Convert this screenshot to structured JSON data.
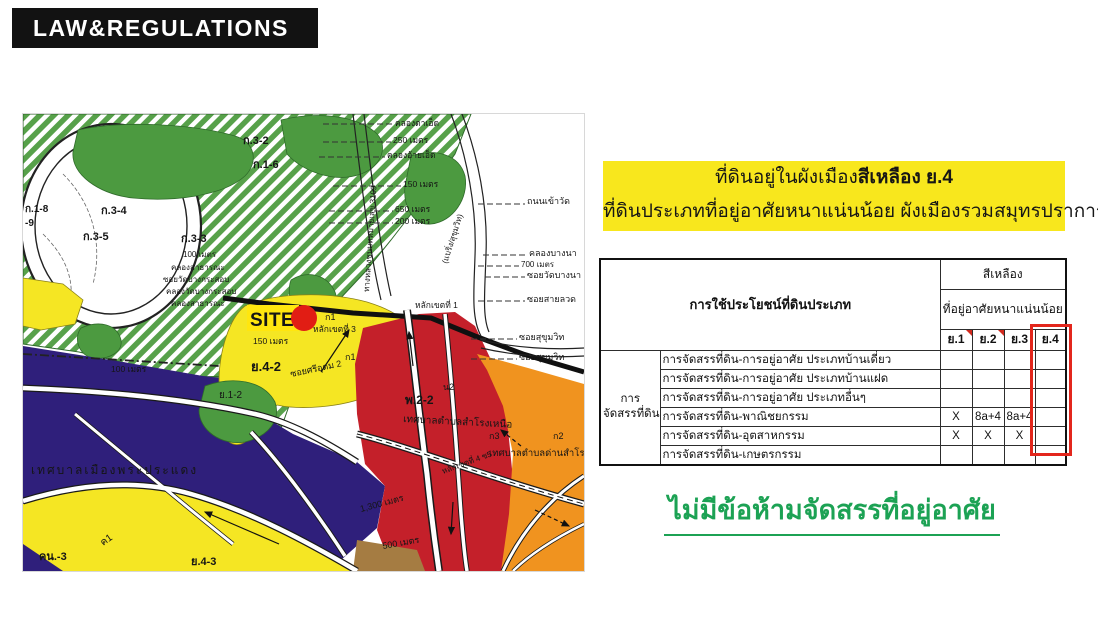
{
  "header": {
    "title": "LAW&REGULATIONS"
  },
  "highlight_box": {
    "bg_color": "#F8E71D",
    "line1_prefix": "ที่ดินอยู่ในผังเมือง",
    "line1_bold": "สีเหลือง ย.4",
    "line2": "ที่ดินประเภทที่อยู่อาศัยหนาแน่นน้อย ผังเมืองรวมสมุทรปราการ"
  },
  "table": {
    "corner_header": "การใช้ประโยชน์ที่ดินประเภท",
    "group_header": "สีเหลือง",
    "sub_header": "ที่อยู่อาศัยหนาแน่นน้อย",
    "columns": [
      "ย.1",
      "ย.2",
      "ย.3",
      "ย.4"
    ],
    "highlight_column": "ย.4",
    "highlight_color": "#E3261C",
    "row_group_label_lines": [
      "การ",
      "จัดสรรที่ดิน"
    ],
    "rows": [
      {
        "label": "การจัดสรรที่ดิน-การอยู่อาศัย ประเภทบ้านเดี่ยว",
        "values": [
          "",
          "",
          "",
          ""
        ]
      },
      {
        "label": "การจัดสรรที่ดิน-การอยู่อาศัย ประเภทบ้านแฝด",
        "values": [
          "",
          "",
          "",
          ""
        ]
      },
      {
        "label": "การจัดสรรที่ดิน-การอยู่อาศัย ประเภทอื่นๆ",
        "values": [
          "",
          "",
          "",
          ""
        ]
      },
      {
        "label": "การจัดสรรที่ดิน-พาณิชยกรรม",
        "values": [
          "X",
          "8a+4",
          "8a+4",
          ""
        ]
      },
      {
        "label": "การจัดสรรที่ดิน-อุตสาหกรรม",
        "values": [
          "X",
          "X",
          "X",
          ""
        ]
      },
      {
        "label": "การจัดสรรที่ดิน-เกษตรกรรม",
        "values": [
          "",
          "",
          "",
          ""
        ]
      }
    ]
  },
  "conclusion": {
    "text": "ไม่มีข้อห้ามจัดสรรที่อยู่อาศัย",
    "color": "#1CA254"
  },
  "map": {
    "site_label": "SITE",
    "colors": {
      "yellow_zone": "#F5E623",
      "purple_zone": "#2F1F7B",
      "red_zone": "#C4202A",
      "orange_zone": "#F0931F",
      "green_zone": "#4C9A40",
      "green_hatch": "#57A14A",
      "brown_zone": "#A57C42",
      "site_marker": "#E11D14"
    },
    "labels": [
      {
        "t": "ก.1-8",
        "x": 2,
        "y": 98,
        "s": 10,
        "b": 1
      },
      {
        "t": "-9",
        "x": 2,
        "y": 112,
        "s": 10,
        "b": 1
      },
      {
        "t": "ก.3-4",
        "x": 78,
        "y": 100,
        "s": 11,
        "b": 1
      },
      {
        "t": "ก.3-5",
        "x": 60,
        "y": 126,
        "s": 11,
        "b": 1
      },
      {
        "t": "ก.3-3",
        "x": 158,
        "y": 128,
        "s": 11,
        "b": 1
      },
      {
        "t": "ก.3-2",
        "x": 220,
        "y": 30,
        "s": 11,
        "b": 1
      },
      {
        "t": "ก.1-6",
        "x": 230,
        "y": 54,
        "s": 11,
        "b": 1
      },
      {
        "t": "100 เมตร",
        "x": 160,
        "y": 143,
        "s": 8
      },
      {
        "t": "คลองสาธารณะ",
        "x": 148,
        "y": 156,
        "s": 8
      },
      {
        "t": "ซอยวัดบางกระสอบ",
        "x": 140,
        "y": 168,
        "s": 8
      },
      {
        "t": "คลองวัดบางกระสอบ",
        "x": 143,
        "y": 180,
        "s": 8
      },
      {
        "t": "คลองสาธารณะ",
        "x": 148,
        "y": 192,
        "s": 8
      },
      {
        "t": "คลองตาเอ็ด",
        "x": 372,
        "y": 12,
        "s": 8.5
      },
      {
        "t": "250 เมตร",
        "x": 370,
        "y": 29,
        "s": 8.5
      },
      {
        "t": "คลองอ้ายเอ็ด",
        "x": 364,
        "y": 44,
        "s": 8.5
      },
      {
        "t": "150 เมตร",
        "x": 380,
        "y": 73,
        "s": 8.5
      },
      {
        "t": "650 เมตร",
        "x": 372,
        "y": 98,
        "s": 8.5
      },
      {
        "t": "200 เมตร",
        "x": 372,
        "y": 110,
        "s": 8.5
      },
      {
        "t": "ทางหลวงชนบทหมายเลข 3109",
        "x": 346,
        "y": 178,
        "s": 8,
        "r": -86
      },
      {
        "t": "(แบริ่ง/สุขุมวิท)",
        "x": 424,
        "y": 150,
        "s": 8,
        "r": -72
      },
      {
        "t": "ถนนเข้าวัด",
        "x": 504,
        "y": 90,
        "s": 9
      },
      {
        "t": "คลองบางนา",
        "x": 506,
        "y": 142,
        "s": 9
      },
      {
        "t": "700 เมตร",
        "x": 498,
        "y": 153,
        "s": 8
      },
      {
        "t": "ซอยวัดบางนา",
        "x": 504,
        "y": 164,
        "s": 9
      },
      {
        "t": "ซอยสายลวด",
        "x": 504,
        "y": 188,
        "s": 9
      },
      {
        "t": "ซอยสุขุมวิท",
        "x": 496,
        "y": 226,
        "s": 9
      },
      {
        "t": "ซอยสุขุมวิท",
        "x": 496,
        "y": 246,
        "s": 9
      },
      {
        "t": "หลักเขตที่ 1",
        "x": 392,
        "y": 194,
        "s": 8.5
      },
      {
        "t": "หลักเขตที่ 3",
        "x": 290,
        "y": 218,
        "s": 8.5
      },
      {
        "t": "ก1",
        "x": 302,
        "y": 206,
        "s": 9
      },
      {
        "t": "ก1",
        "x": 322,
        "y": 246,
        "s": 9
      },
      {
        "t": "ซอยศรีอุดม 2",
        "x": 268,
        "y": 263,
        "s": 9,
        "r": -12
      },
      {
        "t": "ย.4-2",
        "x": 228,
        "y": 257,
        "s": 13,
        "b": 1
      },
      {
        "t": "150 เมตร",
        "x": 230,
        "y": 230,
        "s": 8.5
      },
      {
        "t": "100 เมตร",
        "x": 88,
        "y": 258,
        "s": 8.5
      },
      {
        "t": "ย.1-2",
        "x": 196,
        "y": 284,
        "s": 10,
        "c": "rgba(255,255,255,0.4)"
      },
      {
        "t": "เทศบาลเมืองพระประแดง",
        "x": 8,
        "y": 360,
        "s": 12,
        "c": "rgba(255,255,255,0.5)",
        "sp": 2
      },
      {
        "t": "คน.-3",
        "x": 16,
        "y": 446,
        "s": 11,
        "b": 1
      },
      {
        "t": "ค1",
        "x": 80,
        "y": 432,
        "s": 10,
        "r": -35
      },
      {
        "t": "ย.4-3",
        "x": 168,
        "y": 451,
        "s": 11,
        "b": 1
      },
      {
        "t": "พ.2-2",
        "x": 382,
        "y": 290,
        "s": 12,
        "b": 1,
        "c": "#4a0b0b"
      },
      {
        "t": "น2",
        "x": 420,
        "y": 276,
        "s": 9,
        "c": "#4a0b0b"
      },
      {
        "t": "เทศบาลตำบลสำโรงเหนือ",
        "x": 380,
        "y": 308,
        "s": 10,
        "r": 3,
        "c": "rgba(80,10,10,0.85)"
      },
      {
        "t": "เทศบาลตำบลด่านสำโรง",
        "x": 466,
        "y": 342,
        "s": 9.5,
        "c": "rgba(110,40,5,0.9)"
      },
      {
        "t": "1,300 เมตร",
        "x": 338,
        "y": 398,
        "s": 9,
        "r": -15
      },
      {
        "t": "500 เมตร",
        "x": 360,
        "y": 435,
        "s": 9,
        "r": -10
      },
      {
        "t": "หลักเขตที่ 4 ซ5",
        "x": 420,
        "y": 360,
        "s": 8,
        "r": -20
      },
      {
        "t": "ก3",
        "x": 466,
        "y": 325,
        "s": 9,
        "c": "#5a2405"
      },
      {
        "t": "ก2",
        "x": 530,
        "y": 325,
        "s": 9,
        "c": "#5a2405"
      }
    ]
  }
}
